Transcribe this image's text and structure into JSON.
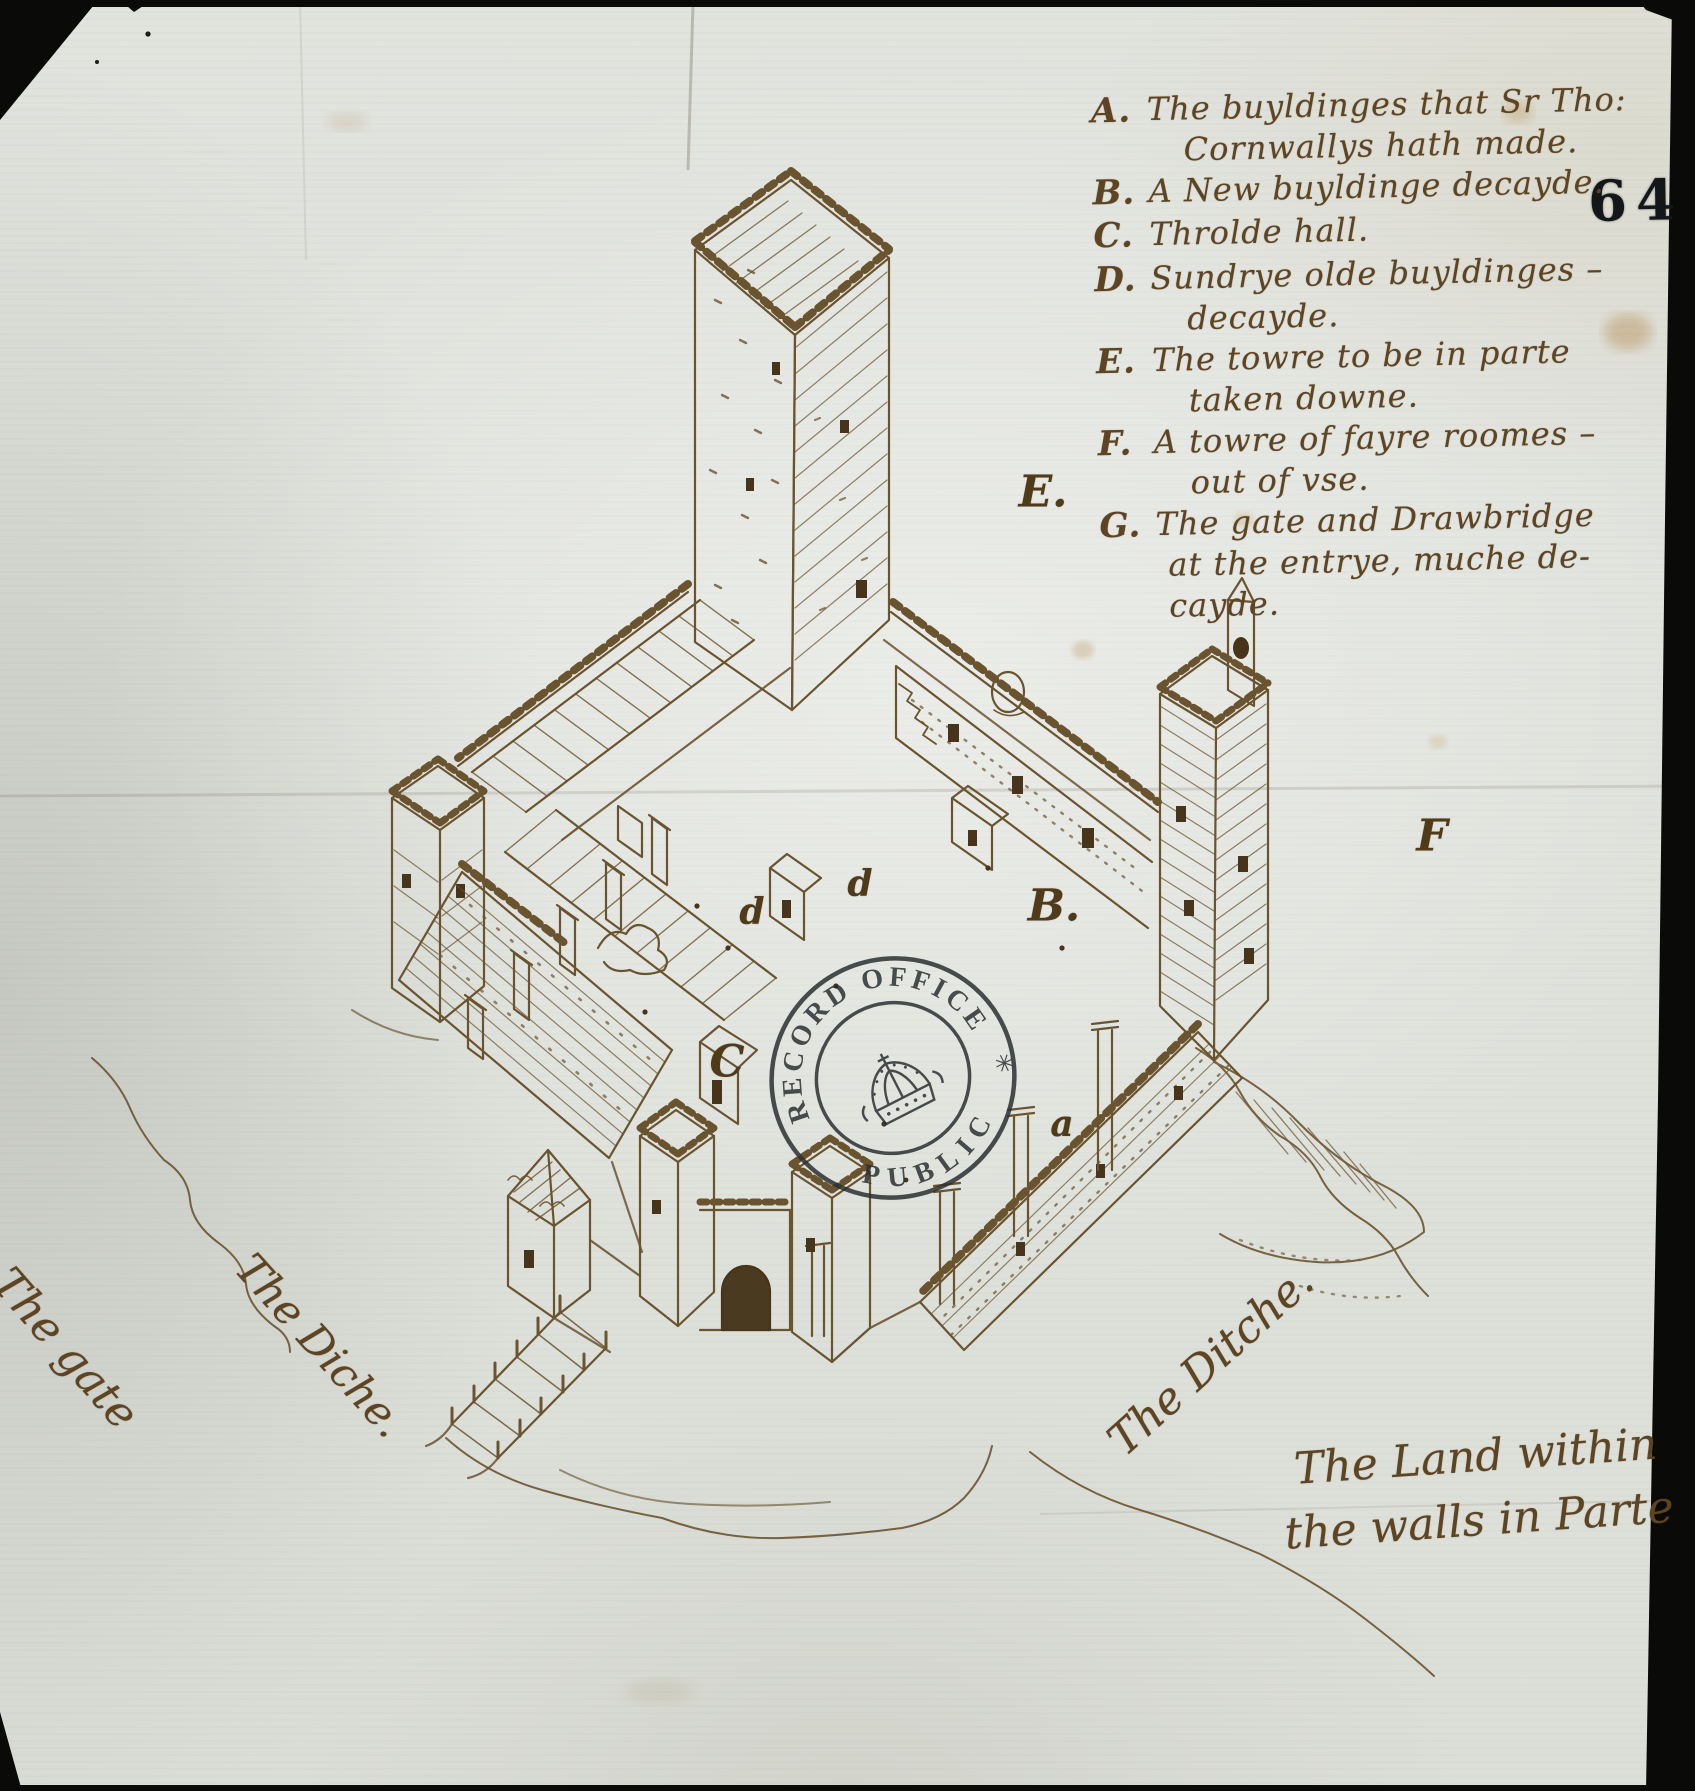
{
  "page": {
    "folio_number": "64",
    "description": "Bird's-eye ink drawing of a moated castle with four corner towers, a great keep, gatehouse and drawbridge"
  },
  "colors": {
    "background": "#0a0a08",
    "paper": "#e0e2dd",
    "ink": "#6a5430",
    "handwriting": "#5d4423",
    "stamp": "#2b2f31",
    "folio": "#14171a"
  },
  "legend": {
    "items": [
      {
        "key": "A.",
        "lines": [
          "The buyldinges that Sr Tho:",
          "Cornwallys hath made."
        ]
      },
      {
        "key": "B.",
        "lines": [
          "A New buyldinge decayde."
        ]
      },
      {
        "key": "C.",
        "lines": [
          "Throlde hall."
        ]
      },
      {
        "key": "D.",
        "lines": [
          "Sundrye olde buyldinges –",
          "decayde."
        ]
      },
      {
        "key": "E.",
        "lines": [
          "The towre to be in parte",
          "taken downe."
        ]
      },
      {
        "key": "F.",
        "lines": [
          "A towre of fayre roomes –",
          "out of vse."
        ]
      },
      {
        "key": "G.",
        "lines": [
          "The gate and Drawbridge",
          "at the entrye, muche de-",
          "cayde."
        ]
      }
    ]
  },
  "map_labels": {
    "gate": "The gate",
    "diche": "The Diche.",
    "ditche": "The Ditche.",
    "land_line1": "The Land within",
    "land_line2": "the walls in Parte"
  },
  "plan_letters": [
    {
      "letter": "E."
    },
    {
      "letter": "F"
    },
    {
      "letter": "B."
    },
    {
      "letter": "d"
    },
    {
      "letter": "d"
    },
    {
      "letter": "C"
    },
    {
      "letter": "a"
    }
  ],
  "stamp": {
    "top": "RECORD OFFICE",
    "bottom": "PUBLIC",
    "star": "✳"
  }
}
